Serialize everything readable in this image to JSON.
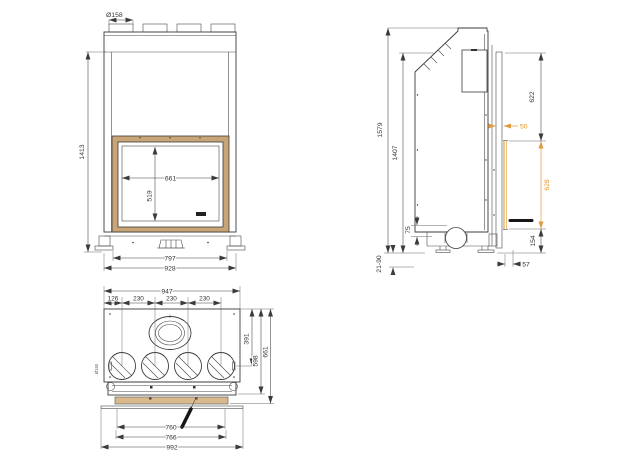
{
  "drawing": {
    "type": "technical dimension drawing",
    "subject": "fireplace insert - three orthographic views",
    "colors": {
      "line": "#3b3b3b",
      "accent_orange": "#e09a3f",
      "glass_frame_tan": "#c9a476"
    }
  },
  "front_view": {
    "flue_diameter": "Ø158",
    "overall_height": "1413",
    "glass_width": "661",
    "glass_height": "519",
    "feet_width": "797",
    "body_width": "928"
  },
  "side_view": {
    "overall_height": "1579",
    "body_height": "1407",
    "upper_front_height": "622",
    "frame_overlap": "50",
    "glass_opening_height": "628",
    "base_height": "154",
    "front_clearance": "57",
    "air_inlet_height": "75",
    "leg_adjustment_range": "21-90"
  },
  "bottom_view": {
    "body_width": "947",
    "first_spigot_offset": "126",
    "spigot_spacing_1": "230",
    "spigot_spacing_2": "230",
    "spigot_spacing_3": "230",
    "flue_center_depth": "391",
    "body_depth": "598",
    "overall_depth": "661",
    "glass_inner_width": "760",
    "glass_outer_width": "766",
    "front_trim_width": "992",
    "spigot_diameter": "Ø150"
  }
}
